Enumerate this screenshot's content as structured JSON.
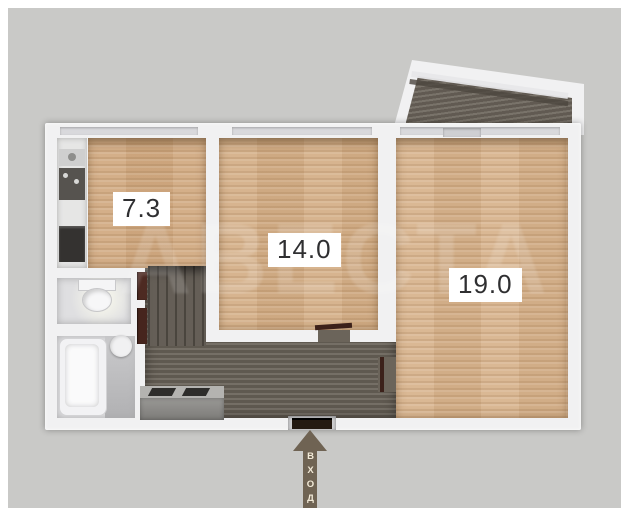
{
  "floor_plan": {
    "watermark_text": "АВЕСТА",
    "entrance": {
      "label": "ВХОД"
    },
    "rooms": [
      {
        "name": "kitchen",
        "area_label": "7.3"
      },
      {
        "name": "living-room",
        "area_label": "14.0"
      },
      {
        "name": "bedroom",
        "area_label": "19.0"
      }
    ],
    "colors": {
      "background": "#c9c9c7",
      "wall": "#f1f1f2",
      "wood_floor": "#d5b089",
      "hallway_floor": "#6b645a",
      "balcony_floor": "#6e675d",
      "door_accent": "#4d2a22",
      "entrance_arrow": "#6f6353",
      "label_text": "#2f2f31"
    }
  }
}
